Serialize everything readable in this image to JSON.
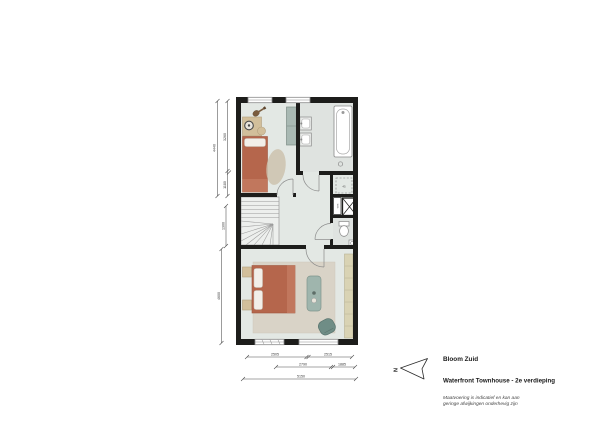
{
  "title_block": {
    "project": "Bloom Zuid",
    "drawing": "Waterfront Townhouse - 2e verdieping",
    "disclaimer1": "Maatvoering is indicatief en kan aan",
    "disclaimer2": "geringe afwijkingen onderhevig zijn"
  },
  "compass": {
    "north": "N"
  },
  "plan": {
    "labels": {
      "washing_machine": "wm",
      "shaft": "45"
    },
    "dim_left": {
      "total": "4440",
      "seg_top": "3260",
      "seg_bottom": "1180",
      "landing": "1300",
      "bedroom": "4600"
    },
    "dim_bottom": {
      "row1_left": "2505",
      "row1_right": "2515",
      "row2_left": "2790",
      "row2_right": "1885",
      "total": "5150"
    }
  },
  "colors": {
    "wall": "#1d1d1b",
    "floor": "#e3e8e4",
    "wet_floor": "#dfe3e0",
    "terracotta": "#b5664c",
    "teal_furniture": "#9fb5ad",
    "green_seat": "#6f8d86",
    "wood": "#d2bf9b",
    "wardrobe": "#d9d3b4",
    "rug": "#d9d3c7"
  }
}
